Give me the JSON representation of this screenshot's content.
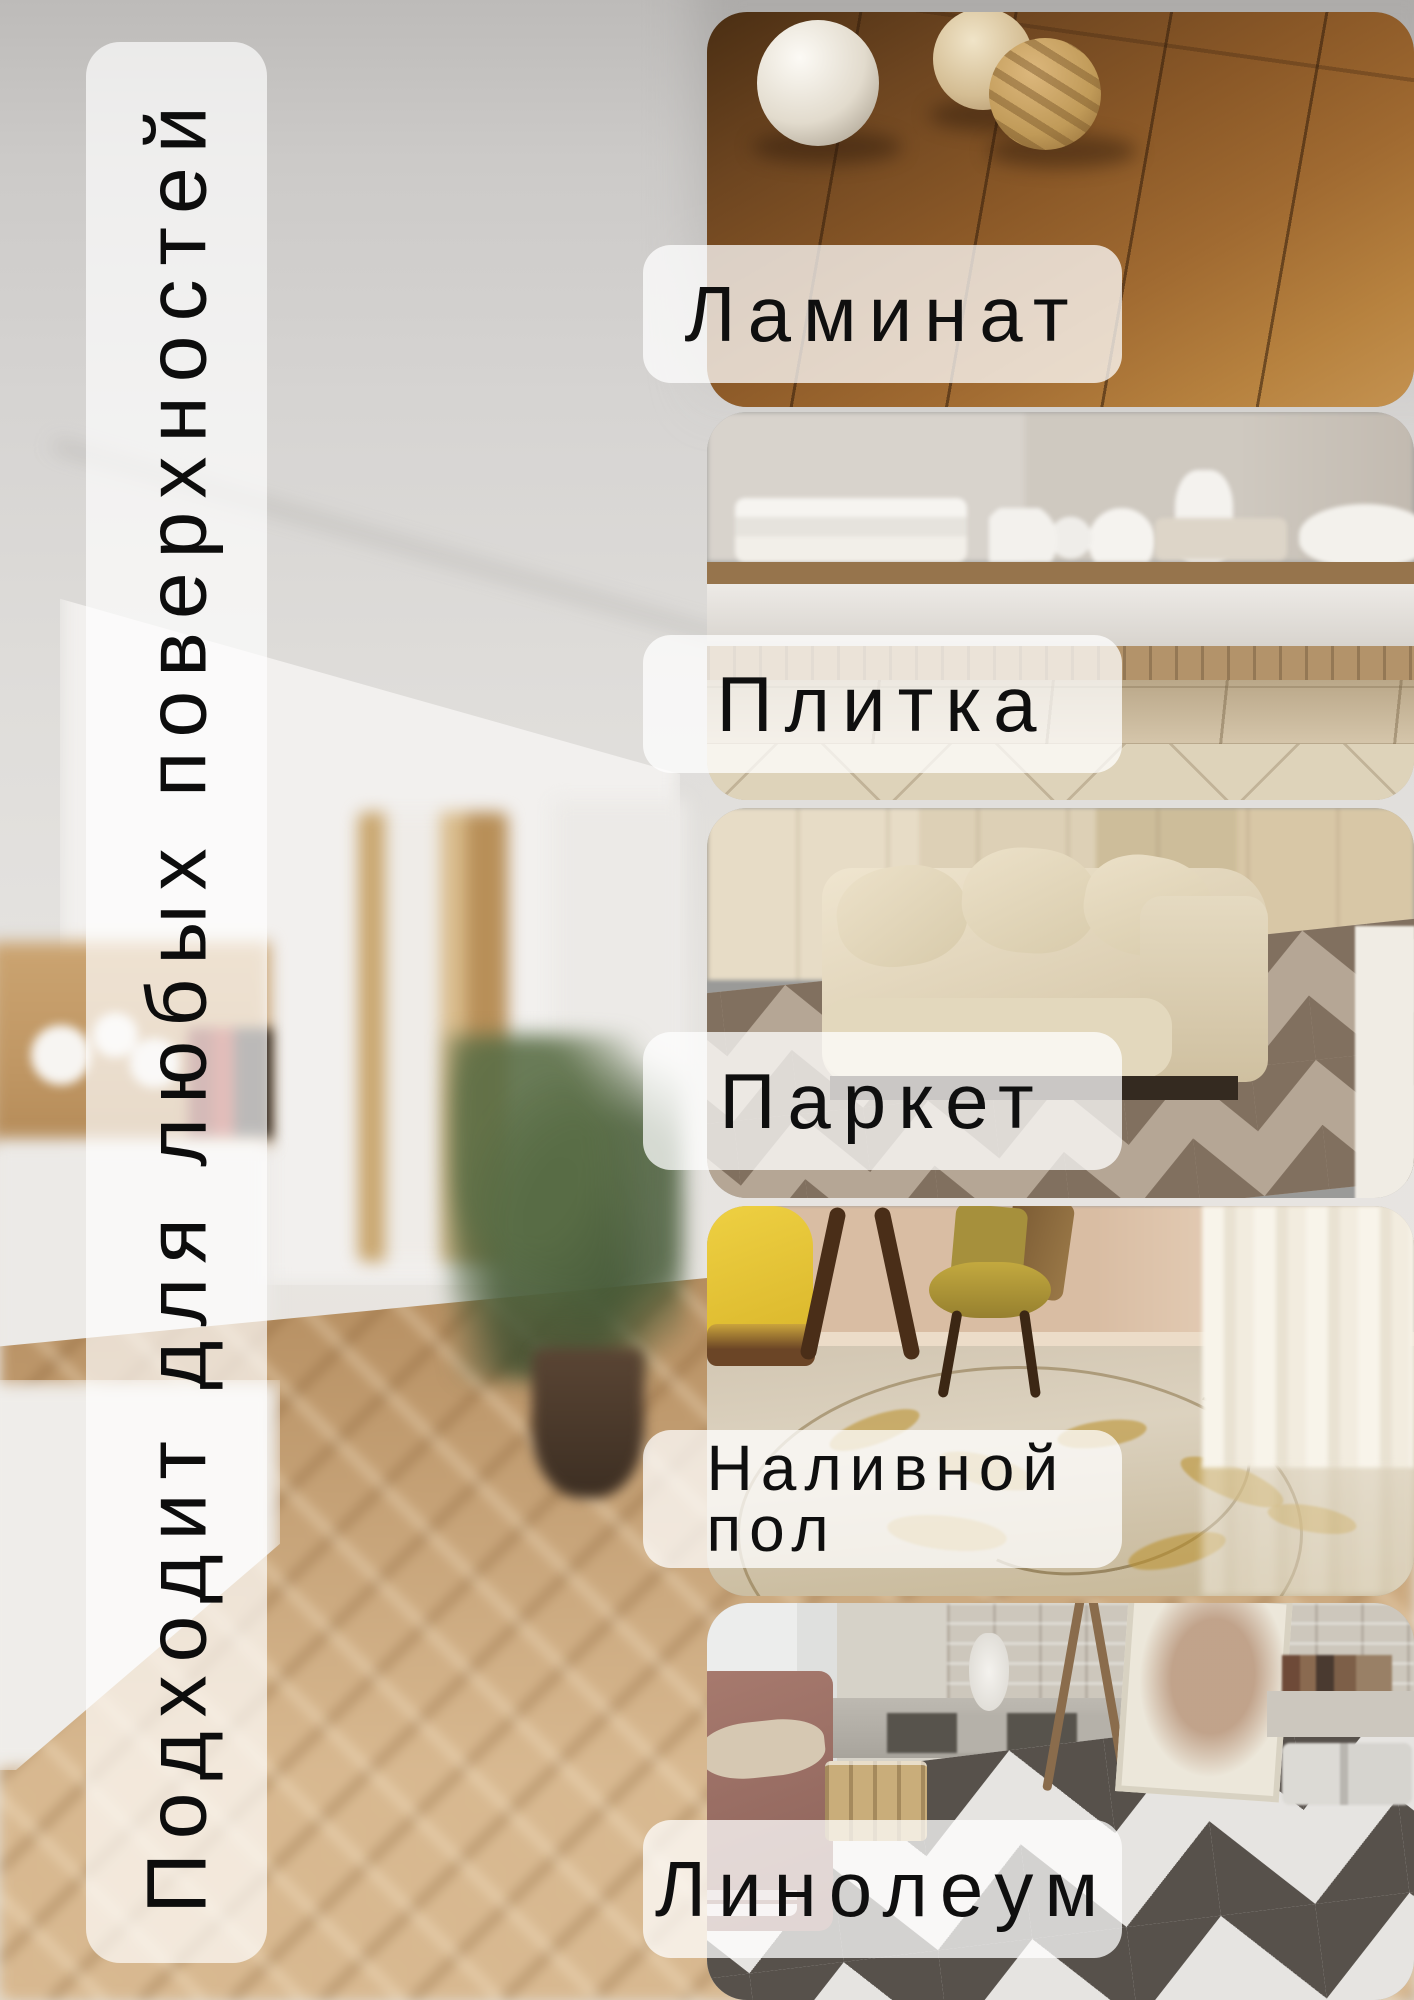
{
  "page": {
    "width": 1414,
    "height": 2000,
    "background": "blurred apartment hallway with white wardrobes, wooden doorway and herringbone oak floor"
  },
  "headline": {
    "text": "Подходит для любых поверхностей",
    "text_color": "#0d0d0d",
    "panel_color": "rgba(255,255,255,0.68)"
  },
  "labels": [
    {
      "text": "Ламинат"
    },
    {
      "text": "Плитка"
    },
    {
      "text": "Паркет"
    },
    {
      "text": "Наливной пол"
    },
    {
      "text": "Линолеум"
    }
  ],
  "photos": [
    {
      "name": "laminate-floor-photo",
      "description": "warm brown laminate planks with three decorative wicker balls"
    },
    {
      "name": "tile-floor-photo",
      "description": "beige ceramic tile floor below a sideboard with white dishes"
    },
    {
      "name": "parquet-floor-photo",
      "description": "chevron parquet floor with cream velvet sofa and cabinets"
    },
    {
      "name": "self-leveling-floor-photo",
      "description": "glossy self-leveling floor with golden ornament, yellow armchair and wooden chairs"
    },
    {
      "name": "linoleum-floor-photo",
      "description": "loft room with bold gray-white chevron linoleum, brick walls and easel"
    }
  ],
  "colors": {
    "label_background": "rgba(255,255,255,0.74)",
    "label_text": "#0f0f0f",
    "photo_corner_radius_px": 40
  }
}
